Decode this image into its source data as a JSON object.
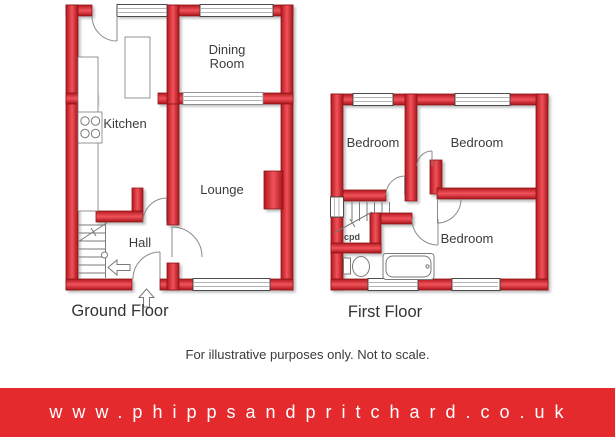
{
  "ground_floor": {
    "title": "Ground Floor",
    "rooms": {
      "kitchen": "Kitchen",
      "dining_line1": "Dining",
      "dining_line2": "Room",
      "lounge": "Lounge",
      "hall": "Hall"
    }
  },
  "first_floor": {
    "title": "First Floor",
    "rooms": {
      "bedroom1": "Bedroom",
      "bedroom2": "Bedroom",
      "bedroom3": "Bedroom",
      "cupboard": "cpd"
    }
  },
  "disclaimer": "For illustrative purposes only. Not to scale.",
  "banner": {
    "url_text": "www.phippsandpritchard.co.uk",
    "background_color": "#e42a2d",
    "text_color": "#ffffff"
  },
  "colors": {
    "wall_red_center": "#f2525a",
    "wall_red_edge": "#b2181f",
    "wall_outline": "#8f1318",
    "fixture_line": "#7a7a7a",
    "label_text": "#3c3c3c"
  }
}
